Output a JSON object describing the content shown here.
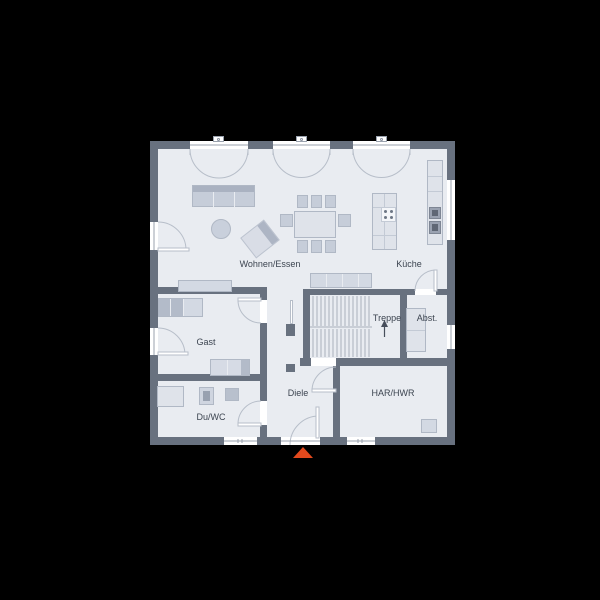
{
  "page": {
    "background_color": "#000000",
    "type": "floor-plan-drawing"
  },
  "plan": {
    "floor_color": "#e9ecf1",
    "wall_color": "#68717f",
    "door_arc_color": "#b7bec9",
    "label_color": "#3c4450",
    "entrance_marker_color": "#e2491d",
    "rooms": [
      {
        "id": "wohnen-essen",
        "label": "Wohnen/Essen"
      },
      {
        "id": "kueche",
        "label": "Küche"
      },
      {
        "id": "treppe",
        "label": "Treppe"
      },
      {
        "id": "abstellraum",
        "label": "Abst."
      },
      {
        "id": "gast",
        "label": "Gast"
      },
      {
        "id": "diele",
        "label": "Diele"
      },
      {
        "id": "du-wc",
        "label": "Du/WC"
      },
      {
        "id": "har-hwr",
        "label": "HAR/HWR"
      }
    ],
    "icons": {
      "entrance_marker": "triangle-up",
      "stair_direction": "arrow-up",
      "french_doors_top_count": 3,
      "windows": [
        "bottom-left",
        "bottom-right",
        "right-upper",
        "right-lower"
      ]
    }
  }
}
